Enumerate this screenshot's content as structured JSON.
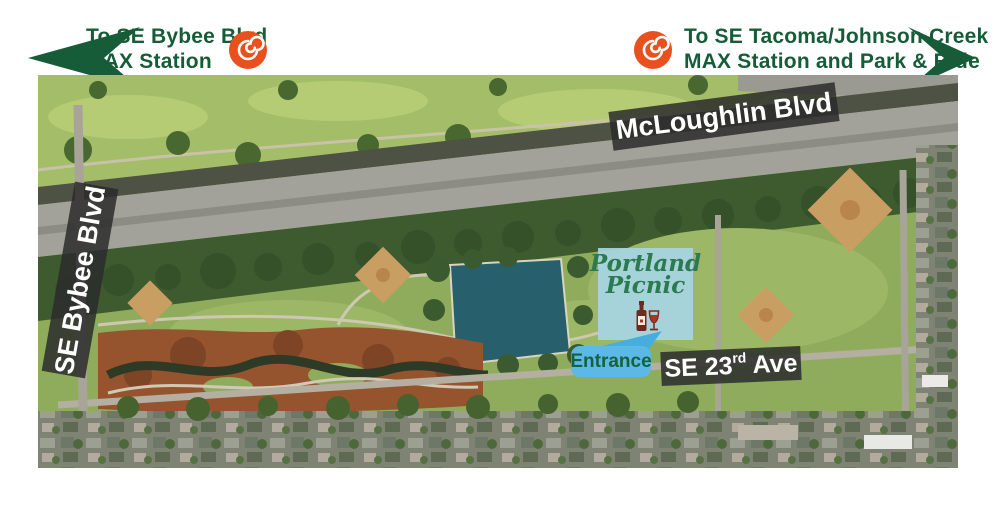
{
  "header": {
    "left_direction": {
      "line1": "To SE Bybee Blvd",
      "line2": "MAX Station"
    },
    "right_direction": {
      "line1": "To SE Tacoma/Johnson Creek",
      "line2": "MAX Station and Park & Ride"
    }
  },
  "map": {
    "labels": {
      "mcloughlin": "McLoughlin Blvd",
      "bybee": "SE Bybee Blvd",
      "se23rd_base": "SE 23",
      "se23rd_sup": "rd",
      "se23rd_rest": " Ave"
    },
    "entrance": {
      "label": "Entrance"
    },
    "logo": {
      "line1": "Portland",
      "line2": "Picnic"
    }
  },
  "colors": {
    "brand_green": "#175c38",
    "max_orange": "#e8501e",
    "entrance_blue": "#5cb8e6",
    "entrance_text_green": "#156240",
    "logo_panel_blue": "#a7d5e3",
    "logo_text_green": "#2b7a50",
    "label_band_gray": "rgba(43,43,43,0.85)",
    "pond_teal": "#27606c"
  }
}
